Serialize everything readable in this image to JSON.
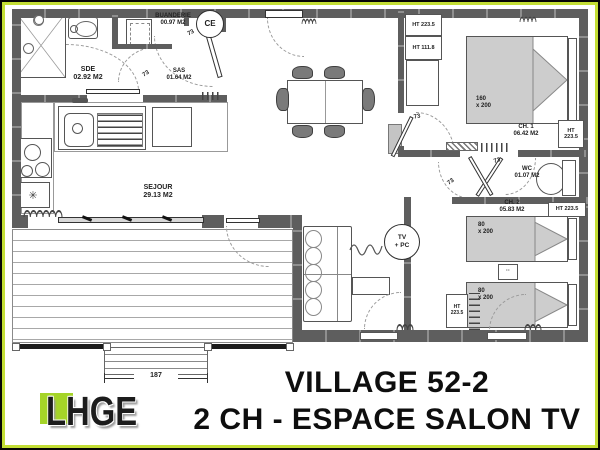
{
  "colors": {
    "frame_green": "#c3de35",
    "wall_gray": "#5e5e5e",
    "bed_gray": "#cdcdcd",
    "logo_green": "#a5d428"
  },
  "title": {
    "line1": "VILLAGE 52-2",
    "line2": "2 CH - ESPACE SALON TV"
  },
  "logo": {
    "text": "LHGE"
  },
  "plan": {
    "rooms": {
      "sde": {
        "name": "SDE",
        "area": "02.92 M2"
      },
      "buanderie": {
        "name": "BUANDERIE",
        "area": "00.97 M2"
      },
      "sas": {
        "name": "SAS",
        "area": "01.64 M2"
      },
      "sejour": {
        "name": "SEJOUR",
        "area": "29.13 M2"
      },
      "ch1": {
        "name": "CH. 1",
        "area": "06.42 M2"
      },
      "wc": {
        "name": "WC",
        "area": "01.07 M2"
      },
      "ch2": {
        "name": "CH. 2",
        "area": "05.83 M2"
      }
    },
    "closets": {
      "c1": "HT 223.5",
      "c2": "HT 111.8",
      "ch1_right_l1": "HT",
      "ch1_right_l2": "223.5",
      "ch2_right": "HT 223.5",
      "ch2_bottom_l1": "HT",
      "ch2_bottom_l2": "223.5"
    },
    "beds": {
      "double": {
        "l1": "160",
        "l2": "x 200"
      },
      "single1": {
        "l1": "80",
        "l2": "x 200"
      },
      "single2": {
        "l1": "80",
        "l2": "x 200"
      }
    },
    "door_labels": [
      "73",
      "73",
      "73",
      "73",
      "73"
    ],
    "badges": {
      "ce": "CE",
      "tv_l1": "TV",
      "tv_l2": "+ PC"
    },
    "deck": {
      "dimension": "187"
    },
    "misc": {
      "fridge_symbol": "✳",
      "nightstand_dots": "··"
    }
  }
}
